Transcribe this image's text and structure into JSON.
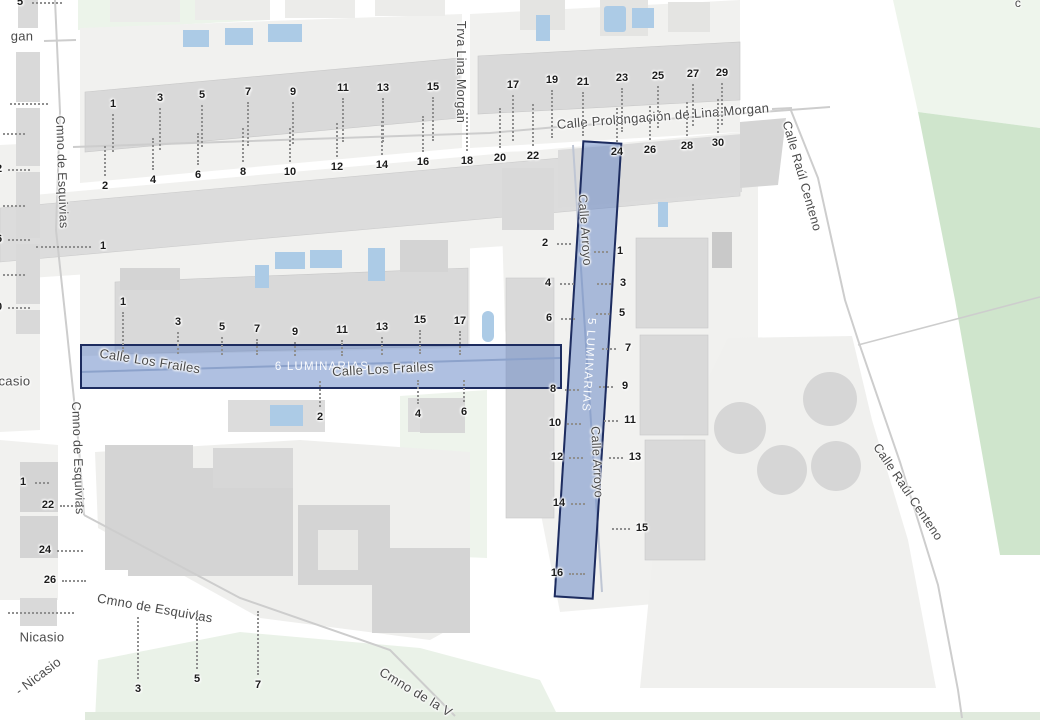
{
  "map": {
    "palette": {
      "bg": "#ffffff",
      "block": "#f1f1ef",
      "building": "#d9d9d9",
      "building_dark": "#c9c9c9",
      "green_pale": "#eef4ec",
      "green_mid": "#cfe5cc",
      "water": "#accbe6",
      "road_line": "#cdcdcd",
      "label": "#4a4a4a",
      "number": "#1b1b1b",
      "hl_fill": "rgba(96,130,195,0.5)",
      "hl_border": "#1d2c5f"
    },
    "highlights": [
      {
        "id": "frailes",
        "street": "Calle Los Frailes",
        "label": "6 LUMINARIAS"
      },
      {
        "id": "arroyo",
        "street": "Calle Arroyo",
        "label": "5 LUMINARIAS"
      }
    ],
    "street_labels": [
      {
        "t": "gan",
        "x": 22,
        "y": 36,
        "r": 0,
        "s": 13
      },
      {
        "t": "Cmno de Esquivias",
        "x": 62,
        "y": 172,
        "r": 88,
        "s": 12.5
      },
      {
        "t": "Trva Lina Morgan",
        "x": 461,
        "y": 72,
        "r": 90,
        "s": 12.5
      },
      {
        "t": "Calle Prolongación de Lina Morgan",
        "x": 663,
        "y": 116,
        "r": -4.5,
        "s": 13
      },
      {
        "t": "Calle Raúl Centeno",
        "x": 802,
        "y": 176,
        "r": 74,
        "s": 12.5
      },
      {
        "t": "Calle Arroyo",
        "x": 585,
        "y": 230,
        "r": 86,
        "s": 12.5
      },
      {
        "t": "Calle Arroyo",
        "x": 597,
        "y": 462,
        "r": 87,
        "s": 12.5
      },
      {
        "t": "Calle Los Frailes",
        "x": 150,
        "y": 361,
        "r": 9,
        "s": 13
      },
      {
        "t": "Calle Los Frailes",
        "x": 383,
        "y": 369,
        "r": -3,
        "s": 13
      },
      {
        "t": "Cmno de Esquivias",
        "x": 78,
        "y": 458,
        "r": 88,
        "s": 12.5
      },
      {
        "t": "Nicasio",
        "x": 8,
        "y": 381,
        "r": 0,
        "s": 13
      },
      {
        "t": "Cmno de Esquivias",
        "x": 155,
        "y": 608,
        "r": 10,
        "s": 13
      },
      {
        "t": "Nicasio",
        "x": 42,
        "y": 637,
        "r": 0,
        "s": 13
      },
      {
        "t": "- Nicasio",
        "x": 38,
        "y": 676,
        "r": -37,
        "s": 13
      },
      {
        "t": "Cmno de la V",
        "x": 416,
        "y": 692,
        "r": 31,
        "s": 13
      },
      {
        "t": "Calle Raúl Centeno",
        "x": 908,
        "y": 492,
        "r": 56,
        "s": 12.5
      },
      {
        "t": "c",
        "x": 1018,
        "y": 3,
        "r": 0,
        "s": 12
      }
    ],
    "house_numbers": [
      {
        "t": "1",
        "x": 113,
        "y": 104,
        "dir": "d",
        "len": 38
      },
      {
        "t": "3",
        "x": 160,
        "y": 98,
        "dir": "d",
        "len": 42
      },
      {
        "t": "5",
        "x": 202,
        "y": 95,
        "dir": "d",
        "len": 42
      },
      {
        "t": "7",
        "x": 248,
        "y": 92,
        "dir": "d",
        "len": 44
      },
      {
        "t": "9",
        "x": 293,
        "y": 92,
        "dir": "d",
        "len": 42
      },
      {
        "t": "11",
        "x": 343,
        "y": 88,
        "dir": "d",
        "len": 44
      },
      {
        "t": "13",
        "x": 383,
        "y": 88,
        "dir": "d",
        "len": 44
      },
      {
        "t": "15",
        "x": 433,
        "y": 87,
        "dir": "d",
        "len": 44
      },
      {
        "t": "17",
        "x": 513,
        "y": 85,
        "dir": "d",
        "len": 46
      },
      {
        "t": "19",
        "x": 552,
        "y": 80,
        "dir": "d",
        "len": 48
      },
      {
        "t": "21",
        "x": 583,
        "y": 82,
        "dir": "d",
        "len": 44
      },
      {
        "t": "23",
        "x": 622,
        "y": 78,
        "dir": "d",
        "len": 44
      },
      {
        "t": "25",
        "x": 658,
        "y": 76,
        "dir": "d",
        "len": 42
      },
      {
        "t": "27",
        "x": 693,
        "y": 74,
        "dir": "d",
        "len": 42
      },
      {
        "t": "29",
        "x": 722,
        "y": 73,
        "dir": "d",
        "len": 42
      },
      {
        "t": "2",
        "x": 105,
        "y": 186,
        "dir": "u",
        "len": 30
      },
      {
        "t": "4",
        "x": 153,
        "y": 180,
        "dir": "u",
        "len": 32
      },
      {
        "t": "6",
        "x": 198,
        "y": 175,
        "dir": "u",
        "len": 32
      },
      {
        "t": "8",
        "x": 243,
        "y": 172,
        "dir": "u",
        "len": 34
      },
      {
        "t": "10",
        "x": 290,
        "y": 172,
        "dir": "u",
        "len": 34
      },
      {
        "t": "12",
        "x": 337,
        "y": 167,
        "dir": "u",
        "len": 34
      },
      {
        "t": "14",
        "x": 382,
        "y": 165,
        "dir": "u",
        "len": 34
      },
      {
        "t": "16",
        "x": 423,
        "y": 162,
        "dir": "u",
        "len": 36
      },
      {
        "t": "18",
        "x": 467,
        "y": 161,
        "dir": "u",
        "len": 38
      },
      {
        "t": "20",
        "x": 500,
        "y": 158,
        "dir": "u",
        "len": 40
      },
      {
        "t": "22",
        "x": 533,
        "y": 156,
        "dir": "u",
        "len": 42
      },
      {
        "t": "24",
        "x": 617,
        "y": 152,
        "dir": "u",
        "len": 34
      },
      {
        "t": "26",
        "x": 650,
        "y": 150,
        "dir": "u",
        "len": 34
      },
      {
        "t": "28",
        "x": 687,
        "y": 146,
        "dir": "u",
        "len": 34
      },
      {
        "t": "30",
        "x": 718,
        "y": 143,
        "dir": "u",
        "len": 34
      },
      {
        "t": "5",
        "x": 20,
        "y": 2,
        "dir": "r",
        "len": 30
      },
      {
        "t": "10",
        "x": -9,
        "y": 133,
        "dir": "r",
        "len": 22
      },
      {
        "t": "12",
        "x": -4,
        "y": 169,
        "dir": "r",
        "len": 22
      },
      {
        "t": "14",
        "x": -9,
        "y": 205,
        "dir": "r",
        "len": 22
      },
      {
        "t": "16",
        "x": -4,
        "y": 239,
        "dir": "r",
        "len": 22
      },
      {
        "t": "18",
        "x": -9,
        "y": 274,
        "dir": "r",
        "len": 22
      },
      {
        "t": "20",
        "x": -4,
        "y": 307,
        "dir": "r",
        "len": 22
      },
      {
        "t": "1",
        "x": 103,
        "y": 246,
        "dir": "l",
        "len": 55
      },
      {
        "t": "1",
        "x": 123,
        "y": 302,
        "dir": "d",
        "len": 40
      },
      {
        "t": "3",
        "x": 178,
        "y": 322,
        "dir": "d",
        "len": 22
      },
      {
        "t": "5",
        "x": 222,
        "y": 327,
        "dir": "d",
        "len": 18
      },
      {
        "t": "7",
        "x": 257,
        "y": 329,
        "dir": "d",
        "len": 16
      },
      {
        "t": "9",
        "x": 295,
        "y": 332,
        "dir": "d",
        "len": 14
      },
      {
        "t": "11",
        "x": 342,
        "y": 330,
        "dir": "d",
        "len": 16
      },
      {
        "t": "13",
        "x": 382,
        "y": 327,
        "dir": "d",
        "len": 18
      },
      {
        "t": "15",
        "x": 420,
        "y": 320,
        "dir": "d",
        "len": 24
      },
      {
        "t": "17",
        "x": 460,
        "y": 321,
        "dir": "d",
        "len": 24
      },
      {
        "t": "2",
        "x": 320,
        "y": 417,
        "dir": "u",
        "len": 26
      },
      {
        "t": "4",
        "x": 418,
        "y": 414,
        "dir": "u",
        "len": 24
      },
      {
        "t": "6",
        "x": 464,
        "y": 412,
        "dir": "u",
        "len": 22
      },
      {
        "t": "2",
        "x": 545,
        "y": 243,
        "dir": "r",
        "len": 14
      },
      {
        "t": "4",
        "x": 548,
        "y": 283,
        "dir": "r",
        "len": 14
      },
      {
        "t": "6",
        "x": 549,
        "y": 318,
        "dir": "r",
        "len": 14
      },
      {
        "t": "8",
        "x": 553,
        "y": 389,
        "dir": "r",
        "len": 14
      },
      {
        "t": "10",
        "x": 555,
        "y": 423,
        "dir": "r",
        "len": 14
      },
      {
        "t": "12",
        "x": 557,
        "y": 457,
        "dir": "r",
        "len": 14
      },
      {
        "t": "14",
        "x": 559,
        "y": 503,
        "dir": "r",
        "len": 14
      },
      {
        "t": "16",
        "x": 557,
        "y": 573,
        "dir": "r",
        "len": 16
      },
      {
        "t": "1",
        "x": 620,
        "y": 251,
        "dir": "l",
        "len": 14
      },
      {
        "t": "3",
        "x": 623,
        "y": 283,
        "dir": "l",
        "len": 14
      },
      {
        "t": "5",
        "x": 622,
        "y": 313,
        "dir": "l",
        "len": 14
      },
      {
        "t": "7",
        "x": 628,
        "y": 348,
        "dir": "l",
        "len": 14
      },
      {
        "t": "9",
        "x": 625,
        "y": 386,
        "dir": "l",
        "len": 14
      },
      {
        "t": "11",
        "x": 630,
        "y": 420,
        "dir": "l",
        "len": 14
      },
      {
        "t": "13",
        "x": 635,
        "y": 457,
        "dir": "l",
        "len": 14
      },
      {
        "t": "15",
        "x": 642,
        "y": 528,
        "dir": "l",
        "len": 18
      },
      {
        "t": "1",
        "x": 23,
        "y": 482,
        "dir": "r",
        "len": 14
      },
      {
        "t": "22",
        "x": 48,
        "y": 505,
        "dir": "r",
        "len": 24
      },
      {
        "t": "24",
        "x": 45,
        "y": 550,
        "dir": "r",
        "len": 26
      },
      {
        "t": "26",
        "x": 50,
        "y": 580,
        "dir": "r",
        "len": 24
      },
      {
        "t": "3",
        "x": 138,
        "y": 689,
        "dir": "u",
        "len": 62
      },
      {
        "t": "5",
        "x": 197,
        "y": 679,
        "dir": "u",
        "len": 58
      },
      {
        "t": "7",
        "x": 258,
        "y": 685,
        "dir": "u",
        "len": 64
      }
    ],
    "dot_rows": [
      {
        "x": 10,
        "y": 103,
        "len": 38
      },
      {
        "x": 8,
        "y": 612,
        "len": 66
      }
    ]
  }
}
